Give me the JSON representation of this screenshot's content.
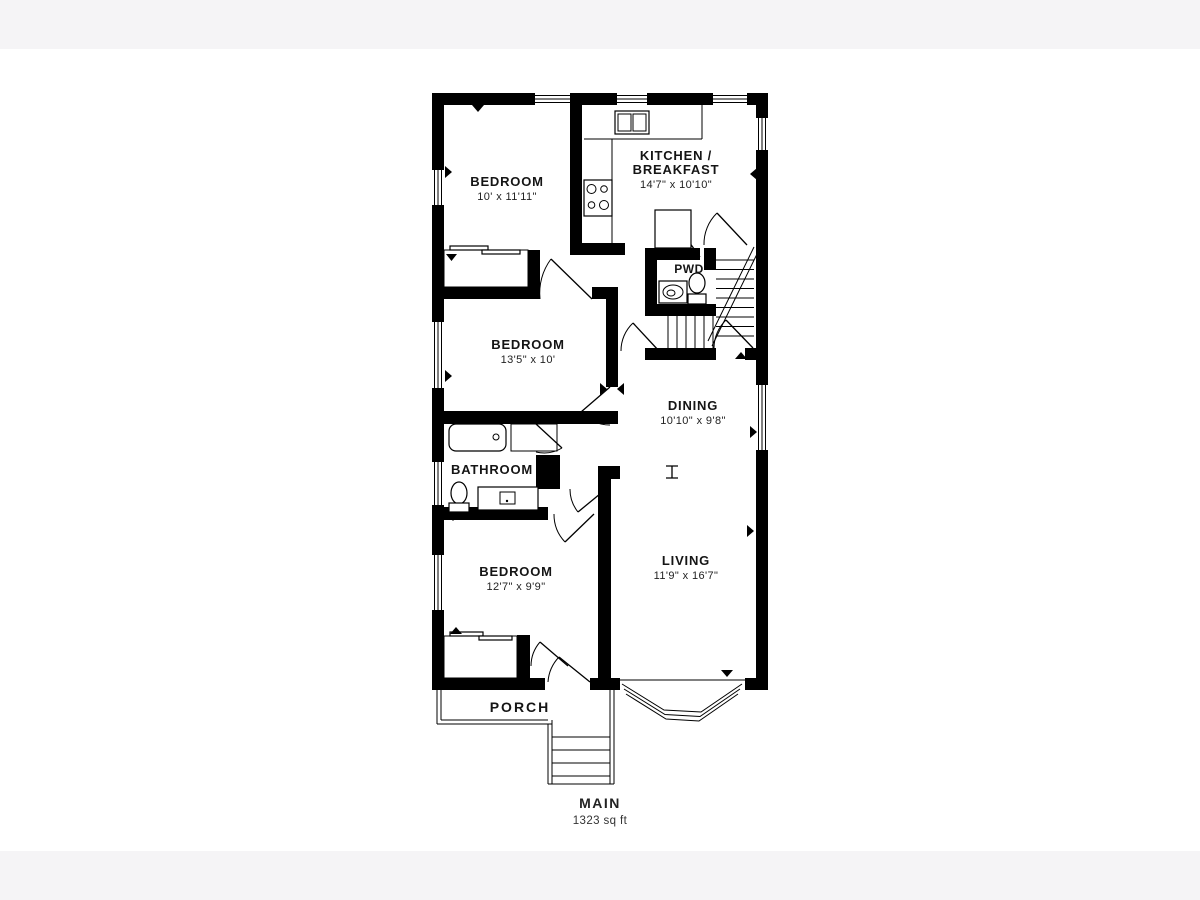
{
  "page": {
    "background": "#f5f4f6",
    "canvas_background": "#ffffff",
    "ink_color": "#000000"
  },
  "floorplan": {
    "rooms": {
      "bedroom_top": {
        "name": "BEDROOM",
        "dims": "10' x 11'11\""
      },
      "kitchen": {
        "name_line1": "KITCHEN /",
        "name_line2": "BREAKFAST",
        "dims": "14'7\" x 10'10\""
      },
      "powder": {
        "name": "PWD"
      },
      "bedroom_middle": {
        "name": "BEDROOM",
        "dims": "13'5\" x 10'"
      },
      "dining": {
        "name": "DINING",
        "dims": "10'10\" x 9'8\""
      },
      "bathroom": {
        "name": "BATHROOM"
      },
      "bedroom_bottom": {
        "name": "BEDROOM",
        "dims": "12'7\" x 9'9\""
      },
      "living": {
        "name": "LIVING",
        "dims": "11'9\" x 16'7\""
      },
      "porch": {
        "name": "PORCH"
      }
    },
    "footer": {
      "level": "MAIN",
      "area": "1323 sq ft"
    }
  }
}
